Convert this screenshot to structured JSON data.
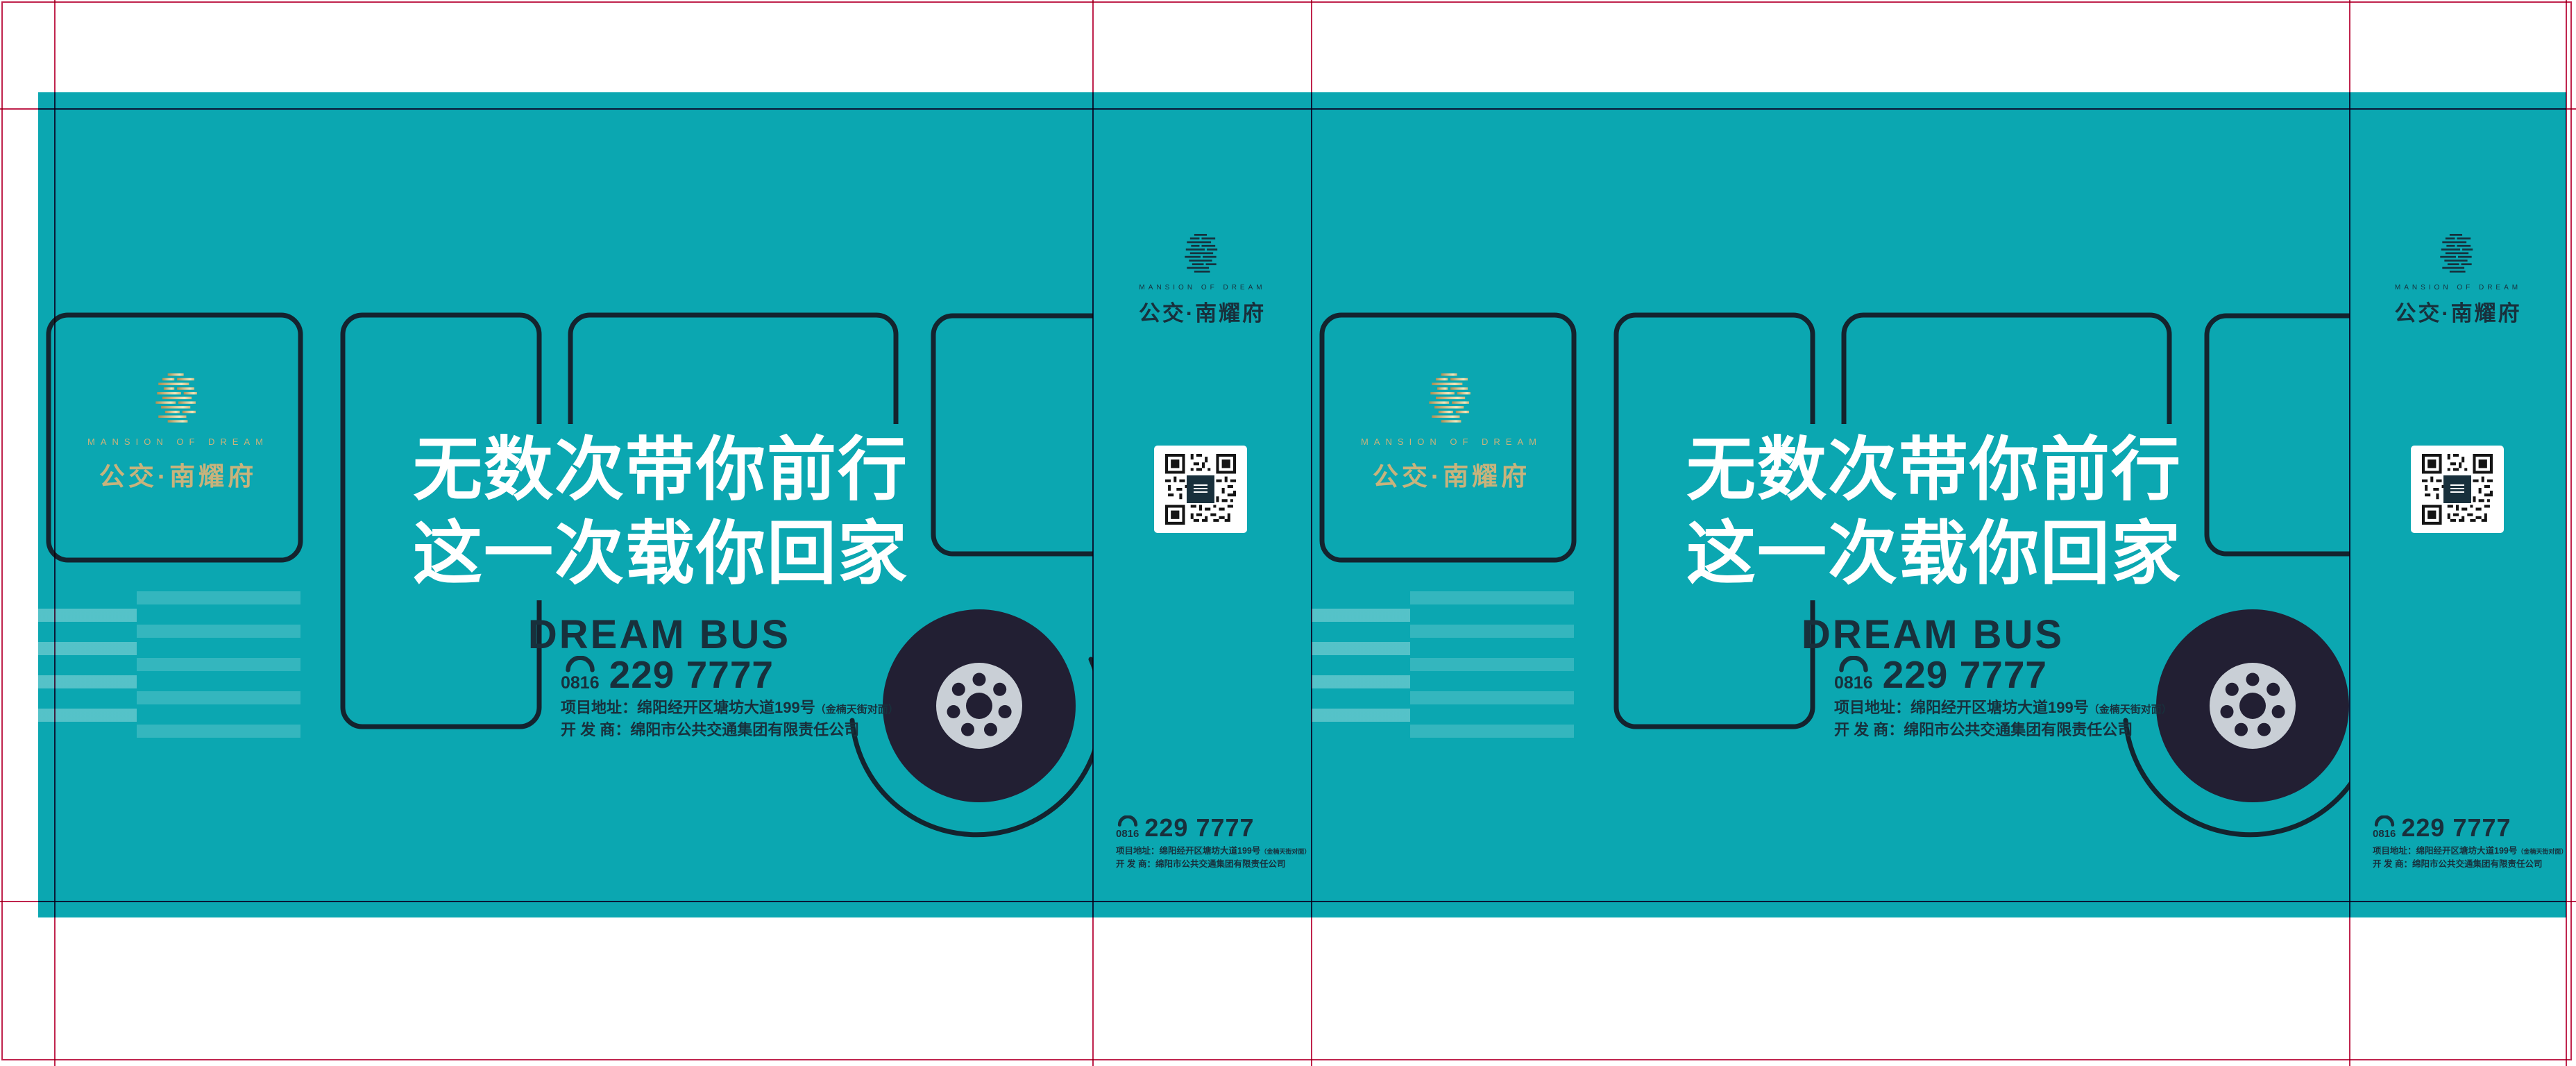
{
  "brand": {
    "en": "MANSION OF DREAM",
    "zh": "公交·南耀府"
  },
  "design": {
    "headline_line1": "无数次带你前行",
    "headline_line2": "这一次载你回家",
    "headline_en": "DREAM BUS"
  },
  "contact": {
    "area_code": "0816",
    "number": "229 7777",
    "address_main": "项目地址：绵阳经开区塘坊大道199号",
    "address_note": "（金楠天街对面）",
    "developer": "开 发 商：绵阳市公共交通集团有限责任公司"
  },
  "colors": {
    "teal_background": "#0ba7b1",
    "navy_text": "#18303c",
    "outline_dark": "#14232e",
    "gold_logo": "#c8b37c",
    "wheel_dark": "#221f33",
    "hub_gray": "#c9cfd6",
    "guide_red": "#c0244d",
    "headline_white": "#ffffff"
  }
}
